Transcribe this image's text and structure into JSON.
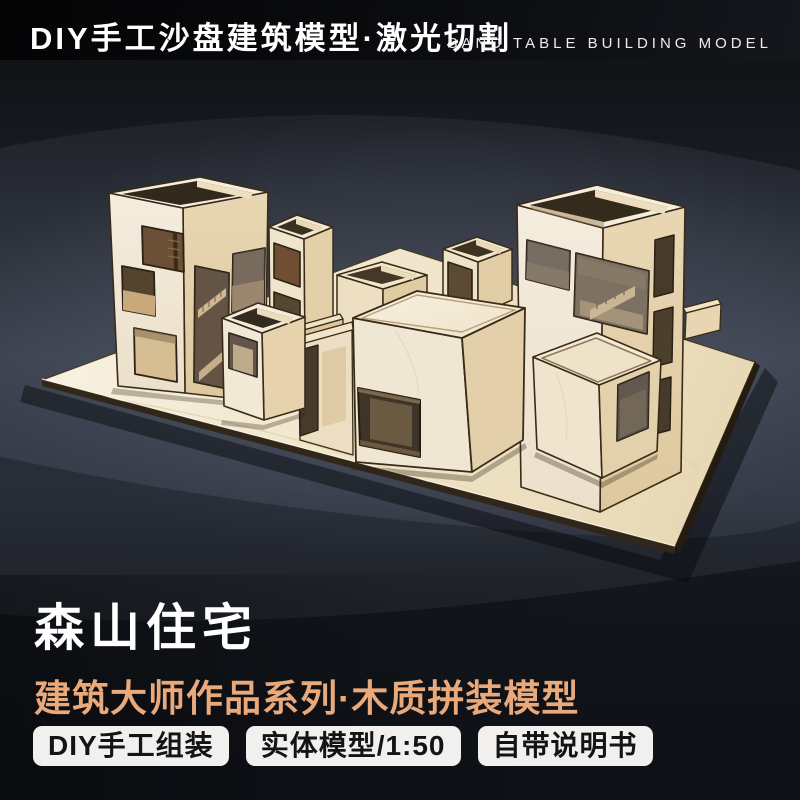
{
  "header": {
    "title_cn": "DIY手工沙盘建筑模型·激光切割",
    "title_en": "SAND TABLE BUILDING MODEL"
  },
  "product": {
    "name": "森山住宅",
    "series": "建筑大师作品系列·木质拼装模型",
    "badges": [
      {
        "label": "DIY手工组装"
      },
      {
        "label": "实体模型/1:50"
      },
      {
        "label": "自带说明书"
      }
    ]
  },
  "photo": {
    "subject": "laser-cut birch plywood architectural model of stacked box houses on a wooden baseplate, studio slate backdrop"
  },
  "colors": {
    "header_bg": "#0B0C0F",
    "backdrop_mid": "#3D4350",
    "backdrop_dark": "#1C2026",
    "accent_orange": "#EAA97A",
    "badge_bg": "#F1F0EE",
    "badge_text": "#141414",
    "title_text": "#FFFFFF",
    "wood_light": "#F3EBDB",
    "wood_mid": "#EAD8B6",
    "wood_shade": "#DFCBA4",
    "wood_edge": "#3A2B18",
    "window_dark": "#54442F"
  }
}
